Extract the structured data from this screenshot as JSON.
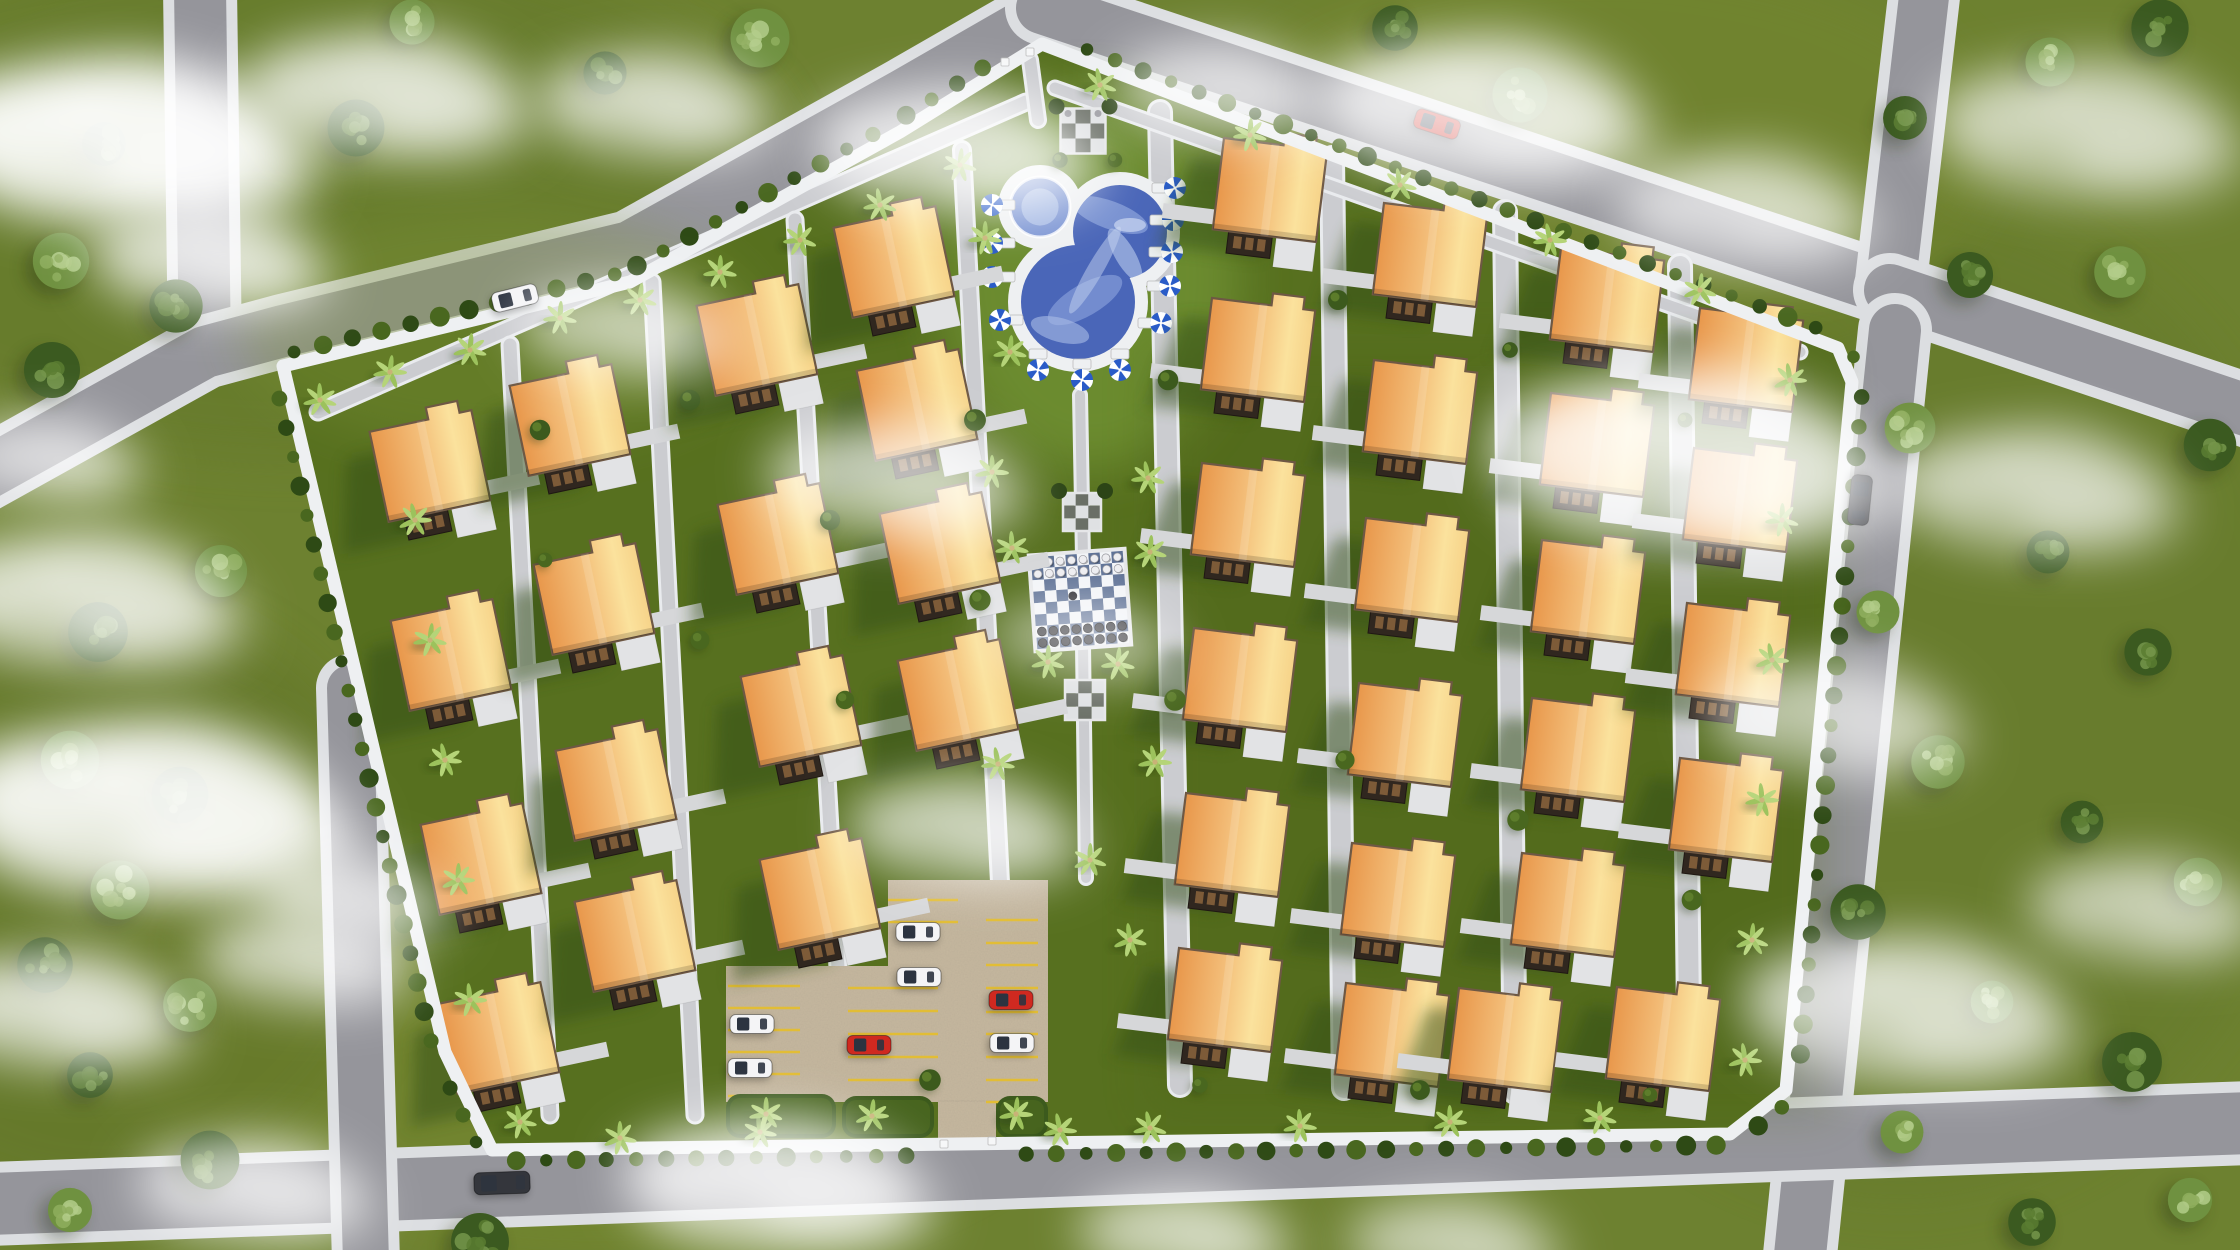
{
  "scene": {
    "width": 2240,
    "height": 1250,
    "description": "aerial-3d-site-plan-residential-community"
  },
  "colors": {
    "grass_outer": "#6d8130",
    "grass_inner": "#57701f",
    "grass_light": "#7d9339",
    "road": "#95959b",
    "road_edge": "#dcdee1",
    "walkway": "#cbccd0",
    "walkway_edge": "#e9ebee",
    "wall": "#eef0f2",
    "hedge_dark": "#2e4a15",
    "hedge_light": "#49671f",
    "roof_dark": "#e8974b",
    "roof_mid": "#f3bd78",
    "roof_light": "#fbe29d",
    "roof_edge": "#6e5844",
    "porch": "#30271f",
    "porch_detail": "#7d5b38",
    "pad": "#e2e3e5",
    "pool_deck": "#eef0f2",
    "water": "#4a66b8",
    "water_light": "#7d96d4",
    "water_lighter": "#aabde6",
    "umbrella_blue": "#2a5cc8",
    "umbrella_white": "#ffffff",
    "chess_white": "#f2f4f7",
    "chess_blue": "#5e7195",
    "piece_white": "#ededf0",
    "piece_black": "#26262b",
    "pad_white": "#dfe1e3",
    "pad_gray": "#6a6f66",
    "gravel": "#c6b89f",
    "stall_yellow": "#e2bd35",
    "car_white": "#f4f4f6",
    "car_red": "#cf2920",
    "car_dark": "#34363c",
    "tree_dark": "#3b5a20",
    "tree_dark_spot": "#5a7c31",
    "tree_dark_hi": "#76974b",
    "tree_light": "#6f9140",
    "tree_light_spot": "#8fae5e",
    "tree_light_hi": "#b3cc8a",
    "palm": "#9cc25c",
    "palm_center": "#c9b277",
    "shadow_green": "#324d12",
    "cloud": "#ffffff"
  },
  "outer_roads": [
    {
      "name": "road-northwest-vertical",
      "pts": [
        [
          200,
          -12
        ],
        [
          205,
          352
        ]
      ],
      "w": 52
    },
    {
      "name": "road-northwest-diagonal",
      "pts": [
        [
          -70,
          505
        ],
        [
          205,
          352
        ],
        [
          283,
          331
        ],
        [
          630,
          247
        ],
        [
          900,
          97
        ],
        [
          1048,
          12
        ]
      ],
      "w": 52
    },
    {
      "name": "road-north-top",
      "pts": [
        [
          1042,
          8
        ],
        [
          1890,
          290
        ]
      ],
      "w": 52
    },
    {
      "name": "road-northeast-up",
      "pts": [
        [
          1890,
          290
        ],
        [
          1925,
          -12
        ]
      ],
      "w": 50
    },
    {
      "name": "road-east-out",
      "pts": [
        [
          1890,
          290
        ],
        [
          2252,
          412
        ]
      ],
      "w": 52
    },
    {
      "name": "road-east-vertical",
      "pts": [
        [
          1895,
          330
        ],
        [
          1800,
          1255
        ]
      ],
      "w": 52
    },
    {
      "name": "road-south-horizontal",
      "pts": [
        [
          -10,
          1204
        ],
        [
          2250,
          1123
        ]
      ],
      "w": 62
    },
    {
      "name": "road-southwest-vertical",
      "pts": [
        [
          350,
          688
        ],
        [
          366,
          1262
        ]
      ],
      "w": 46
    }
  ],
  "community": {
    "wall_pts": [
      [
        283,
        366
      ],
      [
        630,
        282
      ],
      [
        900,
        132
      ],
      [
        1042,
        44
      ],
      [
        1838,
        348
      ],
      [
        1852,
        382
      ],
      [
        1786,
        1090
      ],
      [
        1730,
        1134
      ],
      [
        492,
        1150
      ],
      [
        445,
        1052
      ]
    ],
    "wall_w": 13,
    "hedge_step": 30,
    "gates": [
      [
        1005,
        62
      ],
      [
        1030,
        52
      ],
      [
        944,
        1144
      ],
      [
        992,
        1141
      ]
    ]
  },
  "walkways": [
    {
      "pts": [
        [
          318,
          412
        ],
        [
          1026,
          102
        ]
      ],
      "w": 13
    },
    {
      "pts": [
        [
          510,
          345
        ],
        [
          550,
          1115
        ]
      ],
      "w": 13
    },
    {
      "pts": [
        [
          652,
          282
        ],
        [
          695,
          1115
        ]
      ],
      "w": 13
    },
    {
      "pts": [
        [
          795,
          220
        ],
        [
          838,
          968
        ]
      ],
      "w": 13
    },
    {
      "pts": [
        [
          962,
          150
        ],
        [
          1000,
          882
        ]
      ],
      "w": 14
    },
    {
      "pts": [
        [
          1160,
          112
        ],
        [
          1180,
          1085
        ]
      ],
      "w": 20
    },
    {
      "pts": [
        [
          1332,
          158
        ],
        [
          1344,
          1088
        ]
      ],
      "w": 20
    },
    {
      "pts": [
        [
          1505,
          212
        ],
        [
          1515,
          1092
        ]
      ],
      "w": 20
    },
    {
      "pts": [
        [
          1680,
          266
        ],
        [
          1690,
          1096
        ]
      ],
      "w": 20
    },
    {
      "pts": [
        [
          1055,
          88
        ],
        [
          1800,
          352
        ]
      ],
      "w": 11
    },
    {
      "pts": [
        [
          1080,
          395
        ],
        [
          1083,
          558
        ]
      ],
      "w": 10
    },
    {
      "pts": [
        [
          1083,
          645
        ],
        [
          1086,
          878
        ]
      ],
      "w": 10
    },
    {
      "pts": [
        [
          1030,
          60
        ],
        [
          1038,
          120
        ]
      ],
      "w": 12
    }
  ],
  "houses": {
    "roof_w": 104,
    "roof_h": 92,
    "tab_w": 32,
    "tab_h": 12,
    "left_cluster": {
      "rot": -12,
      "stub": "right",
      "list": [
        [
          430,
          466
        ],
        [
          451,
          655
        ],
        [
          481,
          859
        ],
        [
          499,
          1038
        ],
        [
          570,
          420
        ],
        [
          594,
          599
        ],
        [
          616,
          785
        ],
        [
          635,
          936
        ],
        [
          757,
          340
        ],
        [
          778,
          539
        ],
        [
          801,
          711
        ],
        [
          820,
          894
        ],
        [
          894,
          262
        ],
        [
          917,
          405
        ],
        [
          940,
          548
        ],
        [
          958,
          695
        ]
      ]
    },
    "right_cluster": {
      "rot": 7,
      "stub": "left",
      "list": [
        [
          1270,
          190
        ],
        [
          1258,
          350
        ],
        [
          1248,
          515
        ],
        [
          1240,
          680
        ],
        [
          1232,
          845
        ],
        [
          1225,
          1000
        ],
        [
          1430,
          255
        ],
        [
          1420,
          412
        ],
        [
          1412,
          570
        ],
        [
          1405,
          735
        ],
        [
          1398,
          895
        ],
        [
          1392,
          1035
        ],
        [
          1607,
          300
        ],
        [
          1597,
          445
        ],
        [
          1588,
          592
        ],
        [
          1578,
          750
        ],
        [
          1568,
          905
        ],
        [
          1505,
          1040
        ],
        [
          1746,
          360
        ],
        [
          1740,
          500
        ],
        [
          1733,
          655
        ],
        [
          1726,
          810
        ],
        [
          1663,
          1039
        ]
      ]
    }
  },
  "pool": {
    "spa": {
      "cx": 1040,
      "cy": 207,
      "r": 30,
      "deck_r": 42
    },
    "lobes": [
      {
        "cx": 1120,
        "cy": 232,
        "r": 47
      },
      {
        "cx": 1078,
        "cy": 302,
        "r": 57
      }
    ],
    "deck_pad": 13,
    "lawn_glow": {
      "cx": 1090,
      "cy": 280,
      "rx": 150,
      "ry": 190
    }
  },
  "umbrellas": {
    "r": 11,
    "list": [
      [
        992,
        205,
        "L"
      ],
      [
        992,
        243,
        "L"
      ],
      [
        992,
        277,
        "L"
      ],
      [
        1000,
        320,
        "L"
      ],
      [
        1175,
        188,
        "R"
      ],
      [
        1173,
        220,
        "R"
      ],
      [
        1172,
        252,
        "R"
      ],
      [
        1170,
        286,
        "R"
      ],
      [
        1161,
        323,
        "R"
      ],
      [
        1038,
        370,
        "B"
      ],
      [
        1082,
        380,
        "B"
      ],
      [
        1120,
        370,
        "B"
      ]
    ]
  },
  "chess": {
    "cx": 1080,
    "cy": 600,
    "size": 92,
    "rot": -4,
    "cells": 8
  },
  "checker_pads": [
    {
      "cx": 1083,
      "cy": 131,
      "size": 45,
      "cypress": true,
      "statues": true
    },
    {
      "cx": 1082,
      "cy": 512,
      "size": 38,
      "cypress": true,
      "statues": false
    },
    {
      "cx": 1085,
      "cy": 700,
      "size": 40,
      "cypress": false,
      "statues": false
    }
  ],
  "parking": {
    "rects": [
      [
        726,
        966,
        162,
        136
      ],
      [
        888,
        880,
        160,
        222
      ],
      [
        938,
        1100,
        58,
        48
      ]
    ],
    "stall_banks": [
      {
        "x1": 728,
        "x2": 800,
        "ys": [
          986,
          1008,
          1030,
          1052,
          1074,
          1096
        ]
      },
      {
        "x1": 848,
        "x2": 938,
        "ys": [
          988,
          1011,
          1034,
          1057,
          1080
        ]
      },
      {
        "x1": 986,
        "x2": 1038,
        "ys": [
          920,
          943,
          965,
          988,
          1012,
          1034,
          1057,
          1080,
          1102
        ]
      },
      {
        "x1": 888,
        "x2": 958,
        "ys": [
          900,
          922
        ]
      }
    ],
    "hedge_islands": [
      [
        726,
        1094,
        110,
        44
      ],
      [
        842,
        1096,
        92,
        42
      ],
      [
        996,
        1096,
        52,
        42
      ]
    ],
    "cars": [
      [
        752,
        1024,
        0,
        "white"
      ],
      [
        750,
        1068,
        0,
        "white"
      ],
      [
        869,
        1045,
        0,
        "red"
      ],
      [
        918,
        932,
        0,
        "white"
      ],
      [
        919,
        977,
        0,
        "white"
      ],
      [
        1011,
        1000,
        0,
        "red"
      ],
      [
        1012,
        1043,
        0,
        "white"
      ]
    ]
  },
  "vehicles": [
    {
      "x": 515,
      "y": 298,
      "rot": -14,
      "color": "white",
      "len": 46,
      "wid": 20
    },
    {
      "x": 1437,
      "y": 124,
      "rot": 18,
      "color": "red",
      "len": 46,
      "wid": 20
    },
    {
      "x": 1860,
      "y": 500,
      "rot": 96,
      "color": "dark",
      "len": 50,
      "wid": 21
    },
    {
      "x": 502,
      "y": 1183,
      "rot": -2,
      "color": "dark",
      "len": 56,
      "wid": 22
    }
  ],
  "trees_outer": [
    [
      104,
      144,
      "d"
    ],
    [
      61,
      261,
      "l"
    ],
    [
      176,
      306,
      "d"
    ],
    [
      52,
      370,
      "d"
    ],
    [
      221,
      571,
      "l"
    ],
    [
      98,
      632,
      "d"
    ],
    [
      70,
      760,
      "l"
    ],
    [
      180,
      795,
      "d"
    ],
    [
      120,
      890,
      "l"
    ],
    [
      45,
      965,
      "d"
    ],
    [
      190,
      1005,
      "l"
    ],
    [
      90,
      1075,
      "d"
    ],
    [
      210,
      1160,
      "d"
    ],
    [
      70,
      1210,
      "l"
    ],
    [
      356,
      128,
      "d"
    ],
    [
      412,
      22,
      "l"
    ],
    [
      605,
      73,
      "d"
    ],
    [
      760,
      38,
      "l"
    ],
    [
      1395,
      28,
      "d"
    ],
    [
      1520,
      95,
      "l"
    ],
    [
      1905,
      118,
      "d"
    ],
    [
      2050,
      62,
      "l"
    ],
    [
      2160,
      28,
      "d"
    ],
    [
      1970,
      275,
      "d"
    ],
    [
      2120,
      272,
      "l"
    ],
    [
      2210,
      445,
      "d"
    ],
    [
      1910,
      428,
      "l"
    ],
    [
      2048,
      552,
      "d"
    ],
    [
      1878,
      612,
      "l"
    ],
    [
      2148,
      652,
      "d"
    ],
    [
      1938,
      762,
      "l"
    ],
    [
      2082,
      822,
      "d"
    ],
    [
      2198,
      882,
      "l"
    ],
    [
      1858,
      912,
      "d"
    ],
    [
      1992,
      1002,
      "l"
    ],
    [
      2132,
      1062,
      "d"
    ],
    [
      1902,
      1132,
      "l"
    ],
    [
      2032,
      1222,
      "d"
    ],
    [
      480,
      1242,
      "d"
    ],
    [
      2190,
      1200,
      "l"
    ]
  ],
  "wall_palms": [
    [
      320,
      400
    ],
    [
      390,
      372
    ],
    [
      470,
      350
    ],
    [
      560,
      318
    ],
    [
      640,
      300
    ],
    [
      720,
      272
    ],
    [
      800,
      240
    ],
    [
      880,
      205
    ],
    [
      960,
      165
    ],
    [
      1100,
      85
    ],
    [
      1250,
      135
    ],
    [
      1400,
      185
    ],
    [
      1550,
      240
    ],
    [
      1700,
      290
    ],
    [
      1790,
      380
    ],
    [
      1782,
      520
    ],
    [
      1772,
      660
    ],
    [
      1762,
      800
    ],
    [
      1752,
      940
    ],
    [
      1745,
      1060
    ],
    [
      1600,
      1118
    ],
    [
      1450,
      1122
    ],
    [
      1300,
      1126
    ],
    [
      1150,
      1128
    ],
    [
      1060,
      1130
    ],
    [
      760,
      1132
    ],
    [
      620,
      1138
    ],
    [
      520,
      1122
    ],
    [
      470,
      1000
    ],
    [
      458,
      880
    ],
    [
      445,
      760
    ],
    [
      430,
      640
    ],
    [
      415,
      520
    ]
  ],
  "strip_palms": [
    [
      985,
      238
    ],
    [
      1010,
      352
    ],
    [
      992,
      472
    ],
    [
      1148,
      478
    ],
    [
      1012,
      548
    ],
    [
      1150,
      552
    ],
    [
      1048,
      662
    ],
    [
      1118,
      664
    ],
    [
      1155,
      762
    ],
    [
      998,
      764
    ],
    [
      1090,
      860
    ],
    [
      1130,
      940
    ],
    [
      766,
      1114
    ],
    [
      872,
      1116
    ],
    [
      1016,
      1114
    ]
  ],
  "inner_bushes": [
    [
      540,
      430
    ],
    [
      545,
      560
    ],
    [
      690,
      400
    ],
    [
      700,
      640
    ],
    [
      830,
      520
    ],
    [
      845,
      700
    ],
    [
      975,
      420
    ],
    [
      980,
      600
    ],
    [
      1168,
      380
    ],
    [
      1175,
      700
    ],
    [
      1338,
      300
    ],
    [
      1345,
      760
    ],
    [
      1510,
      350
    ],
    [
      1518,
      820
    ],
    [
      1685,
      420
    ],
    [
      1692,
      900
    ],
    [
      1060,
      160
    ],
    [
      1115,
      160
    ],
    [
      930,
      1080
    ],
    [
      1200,
      1085
    ],
    [
      1420,
      1090
    ],
    [
      1650,
      1095
    ]
  ],
  "clouds": [
    [
      110,
      140,
      1.6,
      0.85
    ],
    [
      380,
      95,
      1.2,
      0.6
    ],
    [
      650,
      105,
      1.0,
      0.55
    ],
    [
      950,
      150,
      1.2,
      0.6
    ],
    [
      1215,
      90,
      0.9,
      0.5
    ],
    [
      1475,
      110,
      1.4,
      0.65
    ],
    [
      1740,
      210,
      1.1,
      0.5
    ],
    [
      2080,
      130,
      1.3,
      0.5
    ],
    [
      205,
      260,
      1.0,
      0.6
    ],
    [
      45,
      460,
      0.8,
      0.5
    ],
    [
      80,
      600,
      1.3,
      0.6
    ],
    [
      140,
      810,
      1.7,
      0.8
    ],
    [
      55,
      1010,
      1.1,
      0.6
    ],
    [
      300,
      960,
      0.9,
      0.5
    ],
    [
      350,
      900,
      0.8,
      0.5
    ],
    [
      250,
      1190,
      1.0,
      0.55
    ],
    [
      890,
      480,
      1.1,
      0.5
    ],
    [
      960,
      830,
      1.0,
      0.5
    ],
    [
      770,
      1185,
      1.3,
      0.65
    ],
    [
      1180,
      1235,
      0.9,
      0.5
    ],
    [
      1680,
      460,
      1.7,
      0.65
    ],
    [
      2030,
      490,
      1.2,
      0.5
    ],
    [
      1830,
      720,
      1.1,
      0.45
    ],
    [
      1900,
      1010,
      1.4,
      0.55
    ],
    [
      2140,
      910,
      1.0,
      0.45
    ],
    [
      1450,
      1245,
      0.9,
      0.45
    ],
    [
      620,
      330,
      0.9,
      0.45
    ],
    [
      1080,
      640,
      0.8,
      0.35
    ]
  ]
}
